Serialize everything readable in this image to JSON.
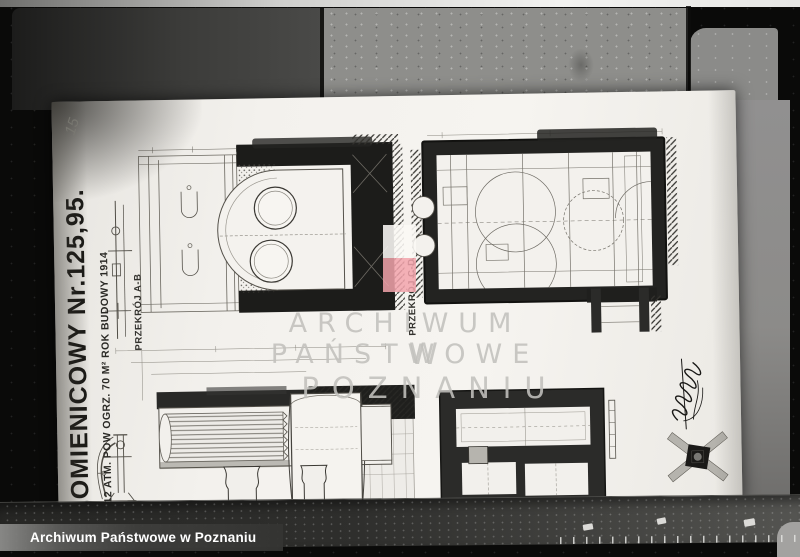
{
  "archive": {
    "caption": "Archiwum Państwowe w Poznaniu",
    "watermark_line1": "ARCHIWUM PAŃSTWOWE",
    "watermark_line2": "W POZNANIU"
  },
  "drawing": {
    "title": "ŁOMIENICOWY Nr.125,95.",
    "spec_line": "B. 12 ATM. POW OGRZ. 70 M² ROK BUDOWY 1914",
    "section_label_ab": "PRZEKRÓJ A-B",
    "section_label_cd": "PRZEKRÓJ C-D",
    "page_number": "15"
  },
  "badge": {
    "top_color": "rgba(250,248,245,0.88)",
    "bottom_color": "rgba(242,163,172,0.85)"
  },
  "colors": {
    "paper": "#f3f1ed",
    "ink_heavy": "#1d1c1a",
    "background": "#0a0a09",
    "watermark_text": "#c2c1bd",
    "caption_text": "#ffffff"
  }
}
